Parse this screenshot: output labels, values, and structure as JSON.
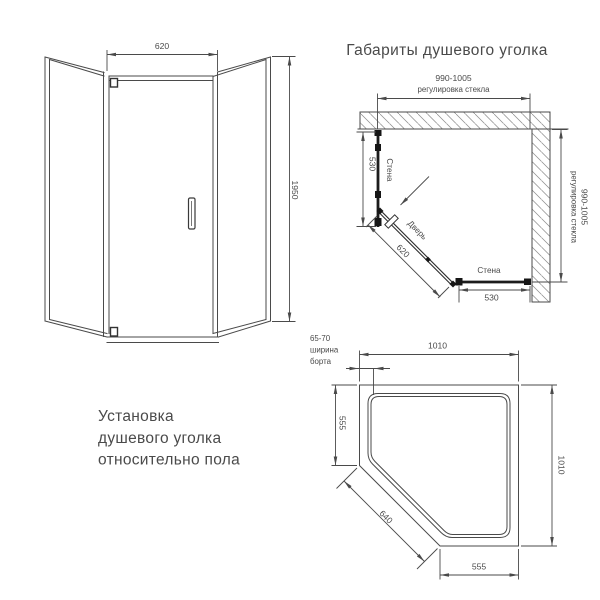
{
  "front_view": {
    "width_dim": "620",
    "height_dim": "1950"
  },
  "plan_view": {
    "title": "Габариты душевого уголка",
    "top_dim": "990-1005",
    "top_dim_note": "регулировка стекла",
    "right_dim": "990-1005",
    "right_dim_note": "регулировка стекла",
    "left_dim": "530",
    "left_wall": "Стена",
    "door": "Дверь",
    "door_dim": "620",
    "bottom_wall": "Стена",
    "bottom_dim": "530"
  },
  "tray_view": {
    "rim_note": [
      "65-70",
      "ширина",
      "борта"
    ],
    "top_dim": "1010",
    "left_dim": "555",
    "diagonal_dim": "640",
    "bottom_dim": "555",
    "right_dim": "1010"
  },
  "caption": [
    "Установка",
    "душевого уголка",
    "относительно пола"
  ],
  "colors": {
    "line": "#4a4a4a",
    "glass": "#1c1c1c",
    "text": "#4a4a4a",
    "background": "#ffffff"
  }
}
